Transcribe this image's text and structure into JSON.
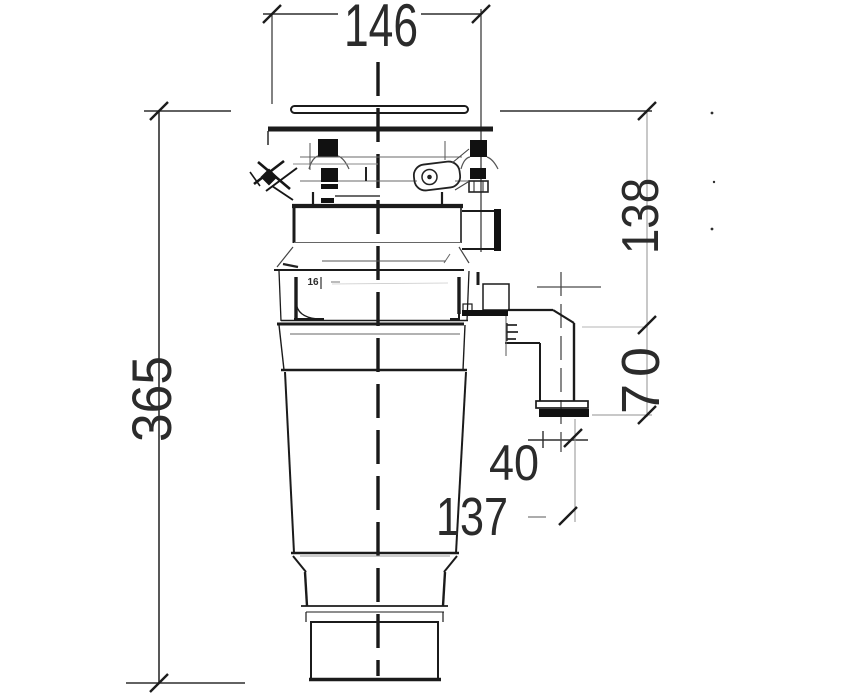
{
  "drawing": {
    "background": "#ffffff",
    "line_color": "#1e1e1e",
    "dimensions": {
      "top_width": "146",
      "overall_height": "365",
      "plate_to_outlet": "138",
      "outlet_to_flange_end": "70",
      "flange_offset": "40",
      "outlet_height": "137",
      "detail_mark": "16"
    }
  }
}
